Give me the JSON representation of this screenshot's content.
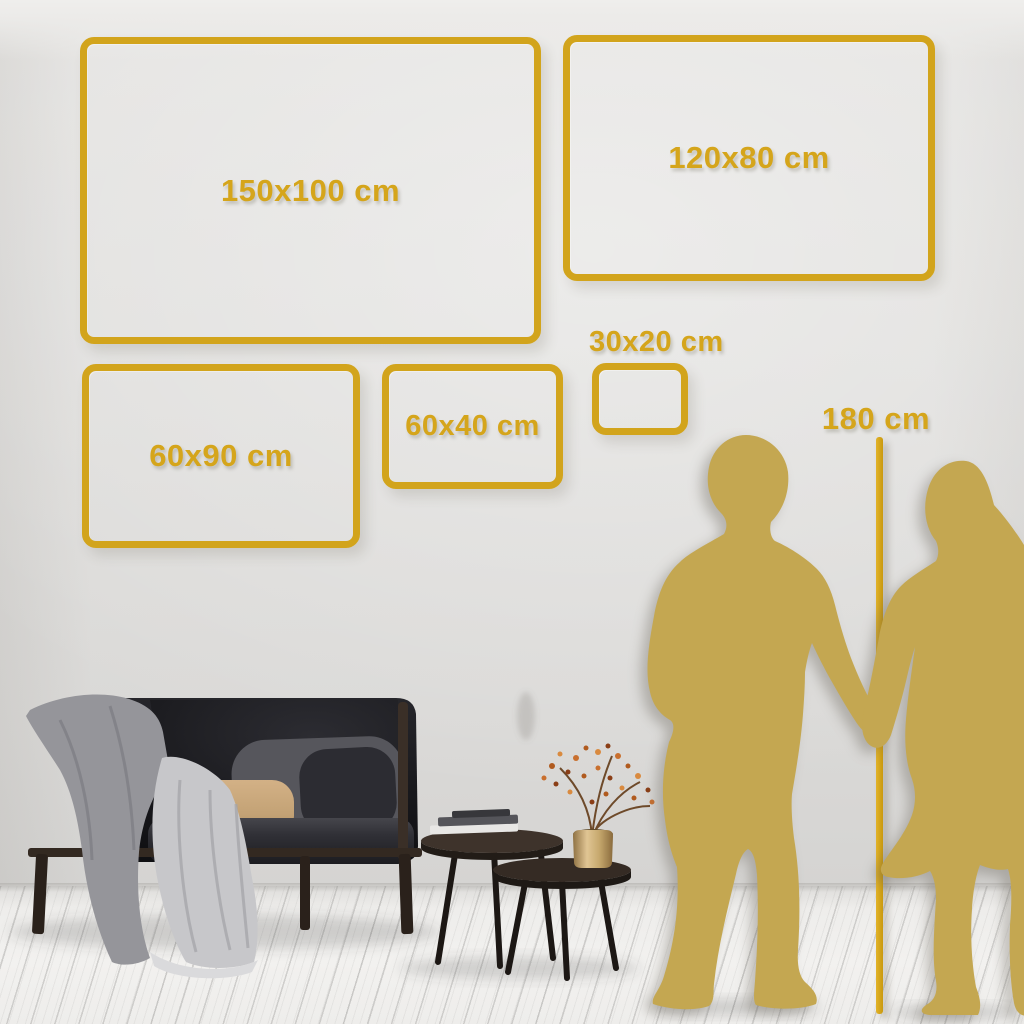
{
  "title": "Wall art size comparison guide",
  "size_guide": {
    "frames": [
      {
        "id": "150x100",
        "label": "150x100 cm"
      },
      {
        "id": "120x80",
        "label": "120x80 cm"
      },
      {
        "id": "30x20",
        "label": "30x20 cm"
      },
      {
        "id": "60x40",
        "label": "60x40 cm"
      },
      {
        "id": "60x90",
        "label": "60x90 cm"
      }
    ],
    "height_marker": {
      "label": "180 cm"
    }
  },
  "scene": {
    "objects": [
      "sofa",
      "throw-blanket",
      "draped-sheet",
      "cushions",
      "nesting-coffee-tables",
      "book-stack",
      "brass-vase-with-dried-branch",
      "man-silhouette",
      "woman-silhouette",
      "height-ruler-line"
    ]
  },
  "colors": {
    "accent_gold": "#D2A41C",
    "silhouette_gold": "#C4A751",
    "wall": "#DEDDDB",
    "floor": "#F0EFED"
  }
}
